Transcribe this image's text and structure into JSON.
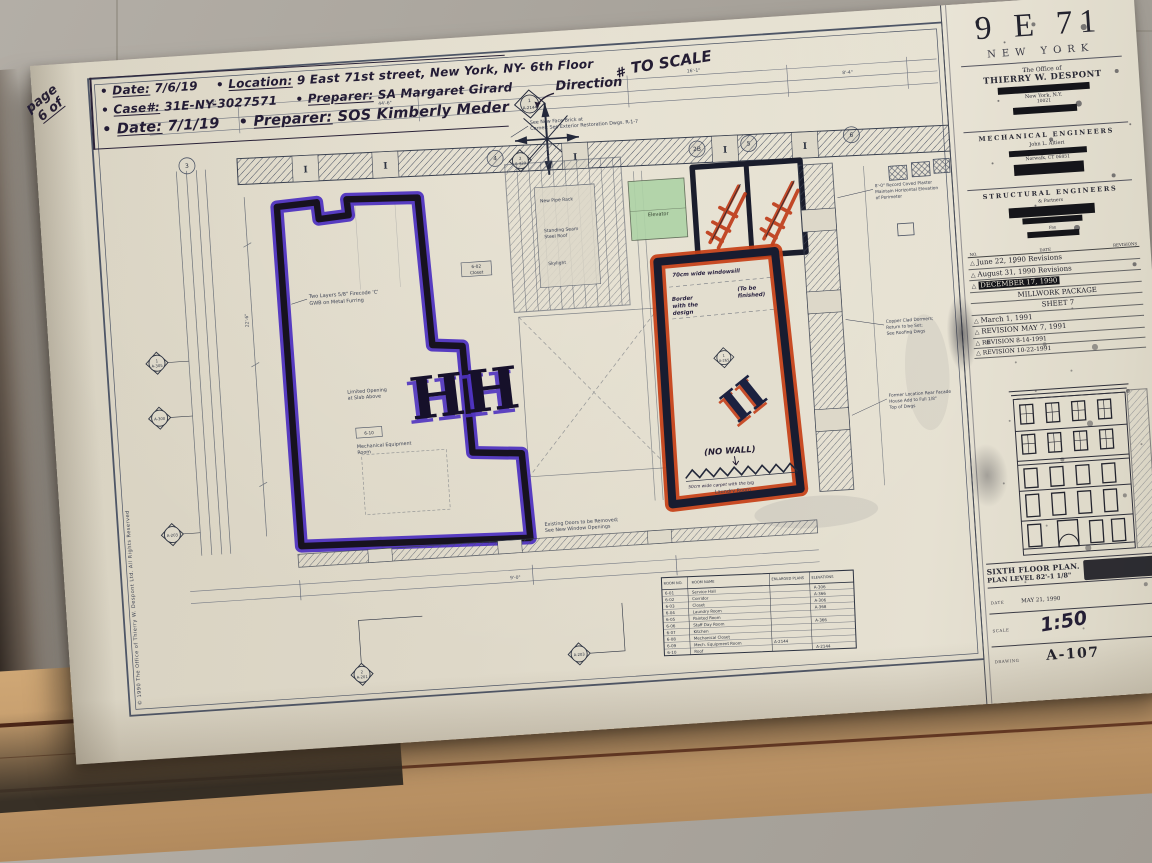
{
  "scene": {
    "floor_color": "#a8a29a",
    "paper_color": "#ddd7c8",
    "under_sheet_color": "#c39a69",
    "purple_marker": "#4f33c0",
    "red_marker": "#c64017",
    "navy_marker": "#181c30",
    "green_highlight": "#aed3a6",
    "ink": "#231c35"
  },
  "handnotes": {
    "bullet": "•",
    "page_word": "page",
    "page_of": "6 of",
    "l1a_label": "Date:",
    "l1a_value": "7/6/19",
    "l1b_label": "Location:",
    "l1b_value": "9 East 71st street, New York, NY- 6th Floor",
    "l2a_label": "Case#:",
    "l2a_value": "31E-NY-3027571",
    "l2b_label": "Preparer:",
    "l2b_value": "SA Margaret Girard",
    "l3a_label": "Date:",
    "l3a_value": "7/1/19",
    "l3b_label": "Preparer:",
    "l3b_value": "SOS Kimberly Meder"
  },
  "plan": {
    "direction": "Direction",
    "to_scale_mark": "#",
    "to_scale": "TO SCALE",
    "marks": {
      "left": "HH",
      "right": "II"
    },
    "no_wall": "(NO WALL)",
    "labels": {
      "elevator": "Elevator",
      "laundry": "Laundry Room",
      "closet_no": "6-02",
      "closet": "Closet",
      "box_tag": "6-10"
    },
    "hand_in_plan": {
      "windowsill": "70cm wide windowsill",
      "border1": "Border",
      "border2": "with the",
      "border3": "design",
      "finish1": "(To be",
      "finish2": "finished)",
      "carpet": "50cm wide carpet with the b/g"
    },
    "notes": {
      "brick1": "See New Face Brick at",
      "brick2": "Corner; See Exterior Restoration Dwgs. R-1-7",
      "gwb1": "Two Layers 5/8\" Firecode 'C'",
      "gwb2": "GWB on Metal Furring",
      "limited1": "Limited Opening",
      "limited2": "at Slab Above",
      "mech1": "Mechanical Equipment",
      "mech2": "Room",
      "pipe": "New Pipe Rack",
      "roof1": "Standing Seam",
      "roof2": "Steel Roof",
      "skylight": "Skylight",
      "existing1": "Existing Doors to be Removed;",
      "existing2": "See New Window Openings",
      "right1a": "8'-0\" Record Coved Plaster",
      "right1b": "Maintain Horizontal Elevation",
      "right1c": "of Perimeter",
      "right2a": "Copper Clad Dormers;",
      "right2b": "Return to be Set;",
      "right2c": "See Roofing Dwgs",
      "right3a": "Former Location Rear Facade",
      "right3b": "House Add to Full 1/8\"",
      "right3c": "Top of Dwgs"
    },
    "grid": [
      "4",
      "2B",
      "5",
      "6",
      "3"
    ],
    "dims": [
      "5'-2\"",
      "44'-6\"",
      "16'-1\"",
      "8'-4\"",
      "22'-6\"",
      "9'-0\""
    ],
    "markers": {
      "c1n": "1",
      "c1": "A-2144",
      "t1n": "2",
      "t1": "A-429",
      "l1n": "1",
      "l1": "A-305",
      "l2": "A-300",
      "l3": "A-203",
      "b1n": "2",
      "b1": "A-201",
      "b2": "A-203",
      "r1n": "1",
      "r1": "A-265"
    },
    "schedule": {
      "headers": [
        "ROOM NO.",
        "ROOM NAME",
        "ENLARGED PLANS",
        "ELEVATIONS"
      ],
      "rows": [
        [
          "6-01",
          "Service Hall",
          "",
          "A-306"
        ],
        [
          "6-02",
          "Corridor",
          "",
          "A-366"
        ],
        [
          "6-03",
          "Closet",
          "",
          "A-306"
        ],
        [
          "6-04",
          "Laundry Room",
          "",
          "A-368"
        ],
        [
          "6-05",
          "Painted Room",
          "",
          ""
        ],
        [
          "6-06",
          "Staff Day Room",
          "",
          "A-366"
        ],
        [
          "6-07",
          "Kitchen",
          "",
          ""
        ],
        [
          "6-08",
          "Mechanical Closet",
          "",
          ""
        ],
        [
          "6-09",
          "Mech. Equipment Room",
          "A-2144",
          ""
        ],
        [
          "6-10",
          "Roof",
          "",
          "A-2144"
        ]
      ]
    },
    "copyright": "© 1990 The Office of Thierry W. Despont Ltd.      All Rights Reserved"
  },
  "titleblock": {
    "brand": "9 E 71",
    "city": "NEW YORK",
    "office_line": "The Office of",
    "architect": "THIERRY W. DESPONT",
    "addr_city": "New York, N.Y.",
    "addr_zip": "10021",
    "mech_header": "MECHANICAL ENGINEERS",
    "mech_name": "John L. Altieri",
    "mech_city": "Norwalk, CT 06851",
    "struct_header": "STRUCTURAL ENGINEERS",
    "struct_partners": "& Partners",
    "struct_fax": "Fax",
    "rev_no_label": "NO.",
    "rev_date_label": "DATE",
    "rev_col_label": "REVISIONS",
    "tri": "△",
    "revisions": [
      "June 22, 1990 Revisions",
      "August 31, 1990 Revisions",
      "DECEMBER 17, 1990",
      "MILLWORK PACKAGE",
      "SHEET 7",
      "March 1, 1991",
      "REVISION MAY 7, 1991",
      "REVISION 8-14-1991",
      "REVISION 10-22-1991"
    ],
    "drawing_title1": "SIXTH FLOOR PLAN.",
    "drawing_title2": "PLAN LEVEL 82'-1 1/8\"",
    "date_label": "DATE",
    "date_value": "MAY 21, 1990",
    "scale_label": "SCALE",
    "scale_value": "1:50",
    "drawing_label": "DRAWING",
    "drawing_number": "A-107"
  }
}
